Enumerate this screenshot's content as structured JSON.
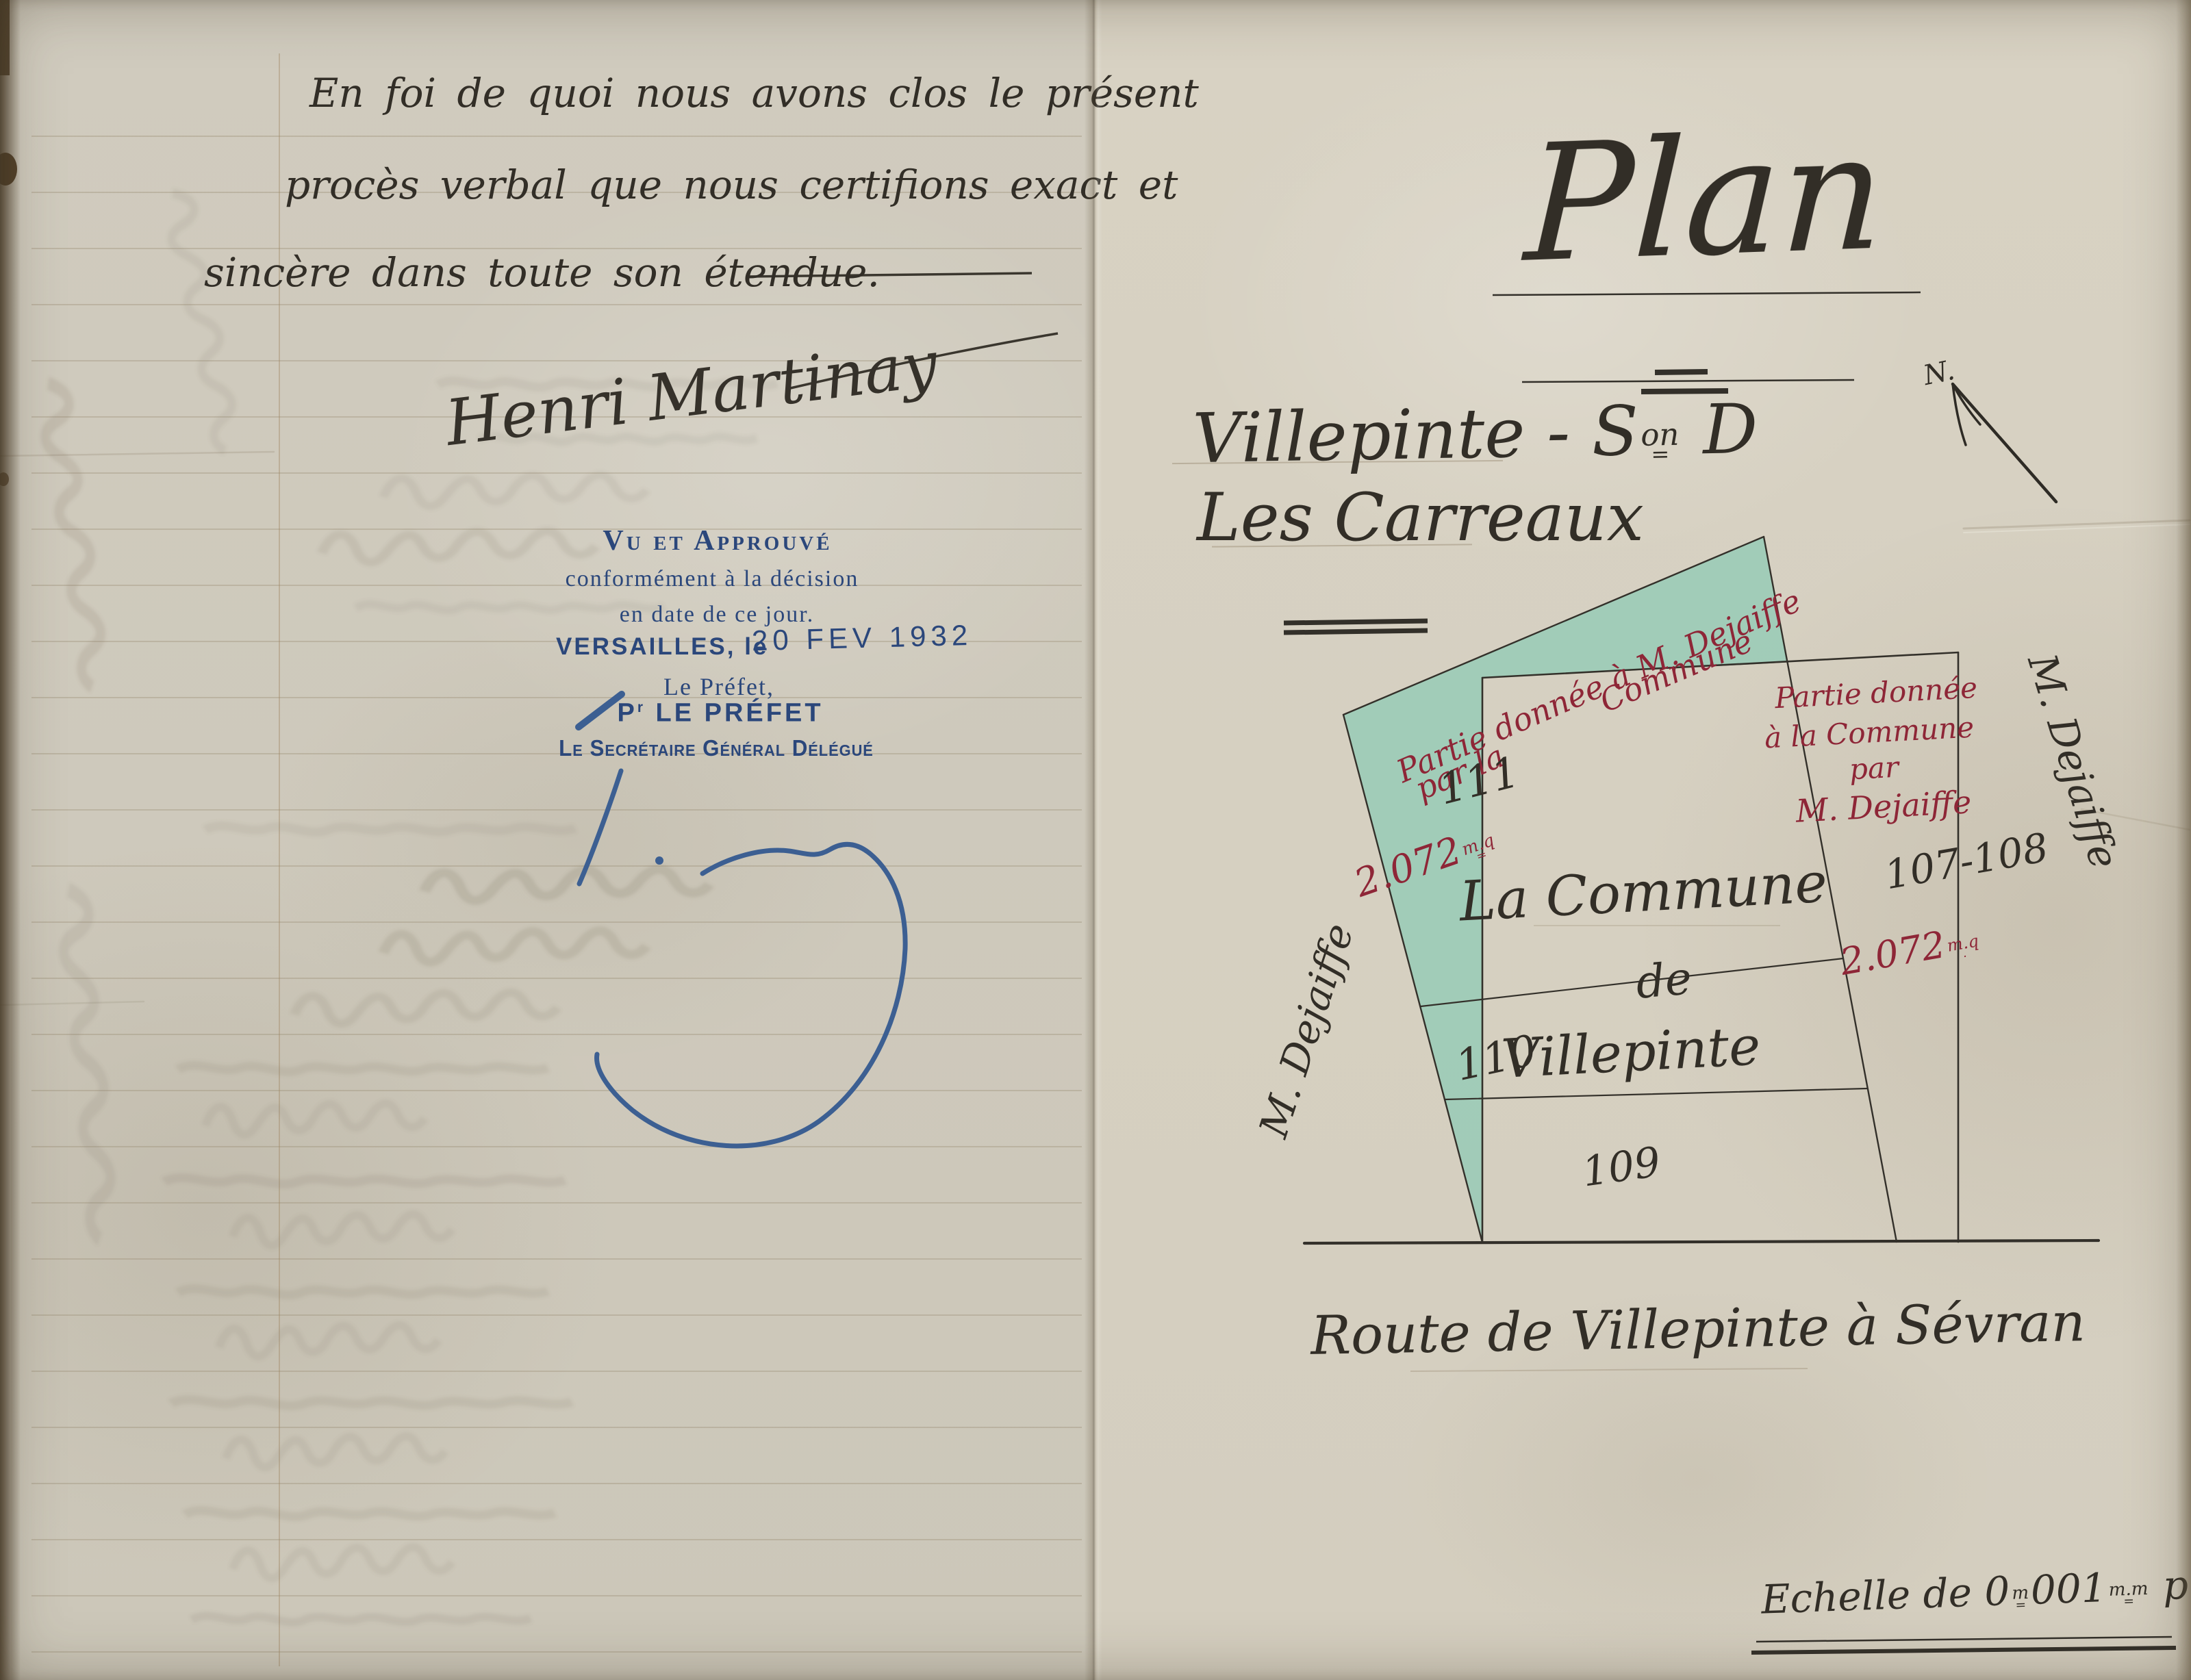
{
  "colors": {
    "paper": "#d5cfc1",
    "ink_black": "#322e27",
    "ink_red": "#8e2637",
    "ink_blue": "#2b477b",
    "wash_green": "#9ccbb7"
  },
  "left_page": {
    "paragraph": [
      "En foi de quoi nous avons clos le présent",
      "procès verbal que nous certifions exact et",
      "sincère dans toute son étendue."
    ],
    "signature": "Henri Martinay",
    "stamp": {
      "approved": "Vu et Approuvé",
      "line2": "conformément à la décision",
      "line3": "en date de ce jour.",
      "place": "VERSAILLES, le",
      "date": "20 FEV 1932",
      "prefet": "Le Préfet,",
      "pour_pre": "P",
      "pour_sup": "r",
      "pour_post": " LE PRÉFET",
      "secretary": "Le Secrétaire Général Délégué"
    }
  },
  "right_page": {
    "title": "Plan",
    "section": {
      "pre": "Villepinte - S",
      "sup": "on",
      "sup_under": "=",
      "post": " D"
    },
    "lieu_dit": "Les Carreaux",
    "north_label": "N.",
    "plan": {
      "green_note_1": "Partie donnée à M. Dejaiffe",
      "green_note_2": "par la",
      "green_note_3": "Commune",
      "area_left": {
        "value": "2.072",
        "sup": "m.q",
        "under": "="
      },
      "area_right": {
        "value": "2.072",
        "sup": "m.q",
        "under": "."
      },
      "parcel_111": "111",
      "parcel_110": "110",
      "parcel_109": "109",
      "parcel_107_108": "107-108",
      "owner_line_1": "La Commune",
      "owner_line_2": "de",
      "owner_line_3": "Villepinte",
      "right_note_1": "Partie donnée",
      "right_note_2": "à la Commune",
      "right_note_3": "par",
      "right_note_4": "M. Dejaiffe",
      "neighbor_left": "M. Dejaiffe",
      "neighbor_right": "M. Dejaiffe",
      "road": "Route de Villepinte à Sévran"
    },
    "scale": {
      "pre": "Echelle de 0",
      "sup1": "m",
      "sup1_under": "=",
      "mid": "001",
      "sup2": "m.m",
      "sup2_under": "=",
      "post": " p. mètre"
    }
  }
}
